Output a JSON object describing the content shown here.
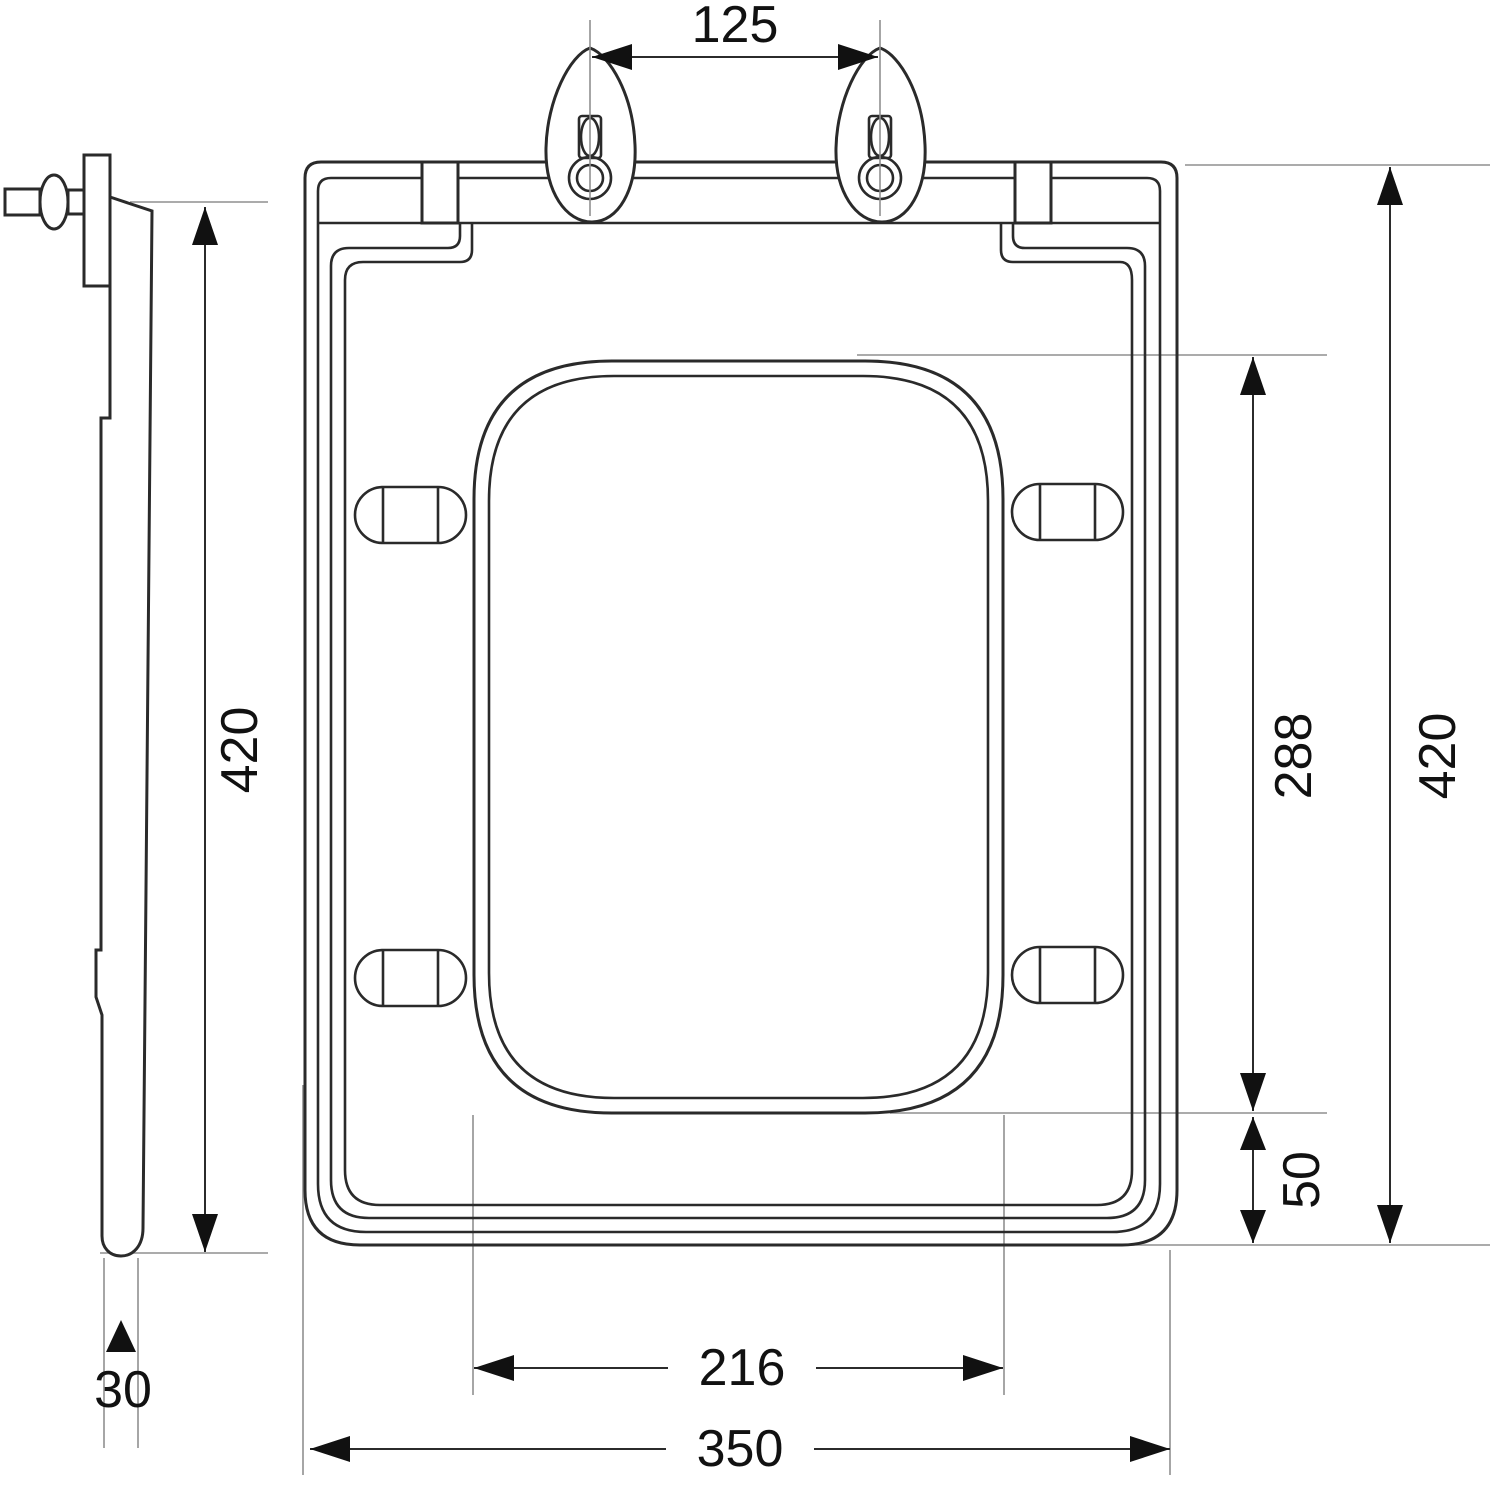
{
  "diagram": {
    "title": "toilet-seat-technical-drawing",
    "views": {
      "side_view": "side-profile",
      "front_view": "top-front"
    },
    "dimensions": {
      "hinge_hole_spacing": "125",
      "side_overall_length": "420",
      "front_overall_length": "420",
      "opening_length": "288",
      "opening_bottom_offset": "50",
      "opening_width": "216",
      "overall_width": "350",
      "seat_thickness": "30"
    },
    "colors": {
      "background": "#ffffff",
      "part_line": "#2a2a2a",
      "dimension_line": "#2b2b2b",
      "extension_line": "#8f8f8f",
      "text": "#111111"
    }
  }
}
